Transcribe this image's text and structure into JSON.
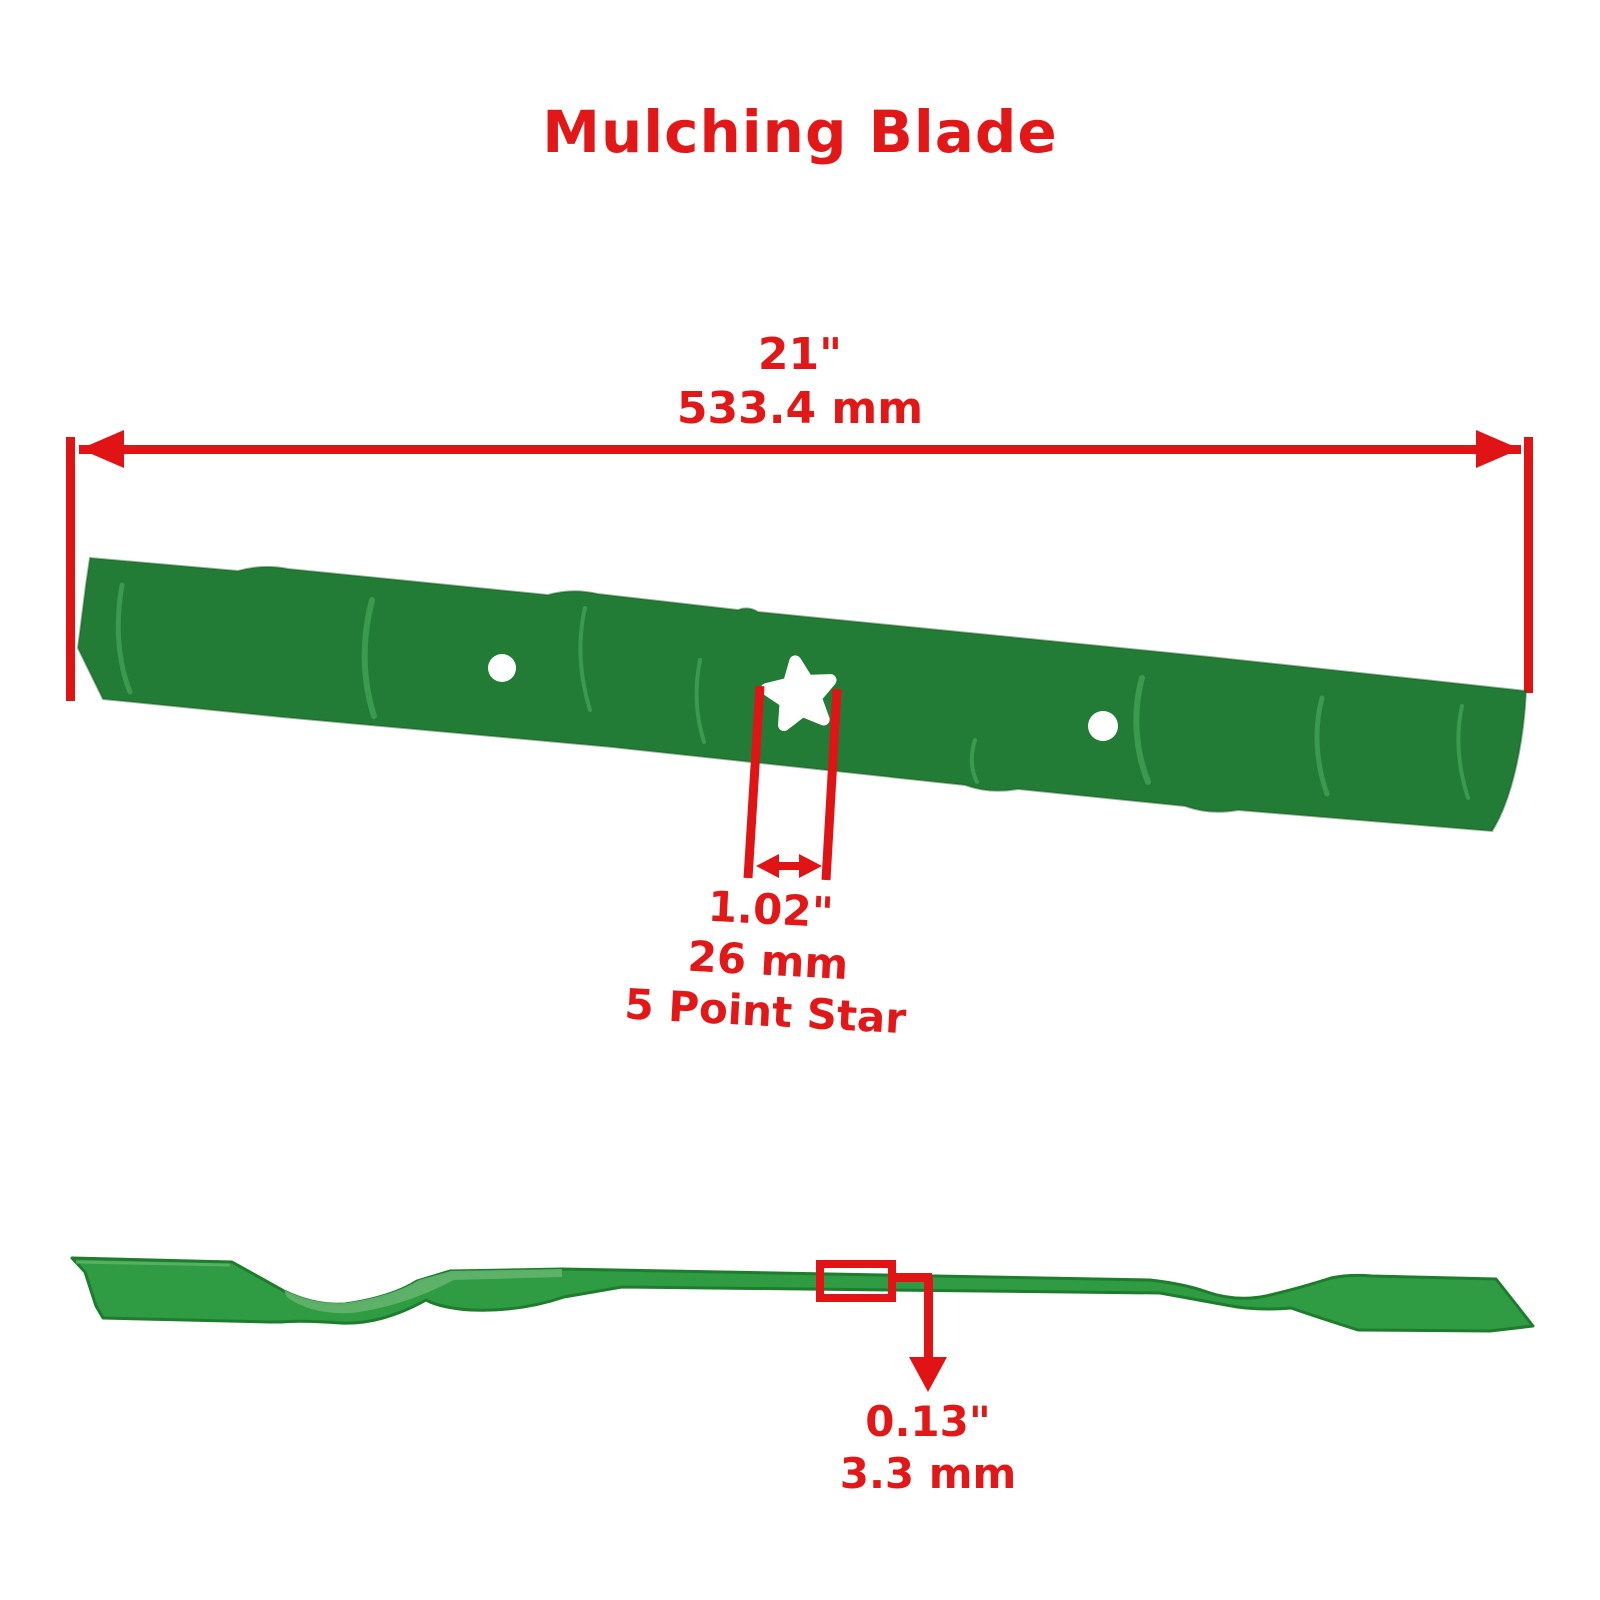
{
  "title": "Mulching Blade",
  "colors": {
    "red_line": "#e01414",
    "red_text": "#e21818",
    "blade_green": "#227c36",
    "blade_green_edge": "#14591f",
    "streak_green": "#5cbd72",
    "profile_green": "#2f9b42",
    "profile_green_light": "#63b46d",
    "profile_green_dark": "#1d7d2d",
    "bg": "#ffffff"
  },
  "dimensions": {
    "length": {
      "inches": "21\"",
      "mm": "533.4 mm"
    },
    "center_hole": {
      "inches": "1.02\"",
      "mm": "26 mm",
      "shape": "5 Point Star"
    },
    "thickness": {
      "inches": "0.13\"",
      "mm": "3.3 mm"
    }
  }
}
